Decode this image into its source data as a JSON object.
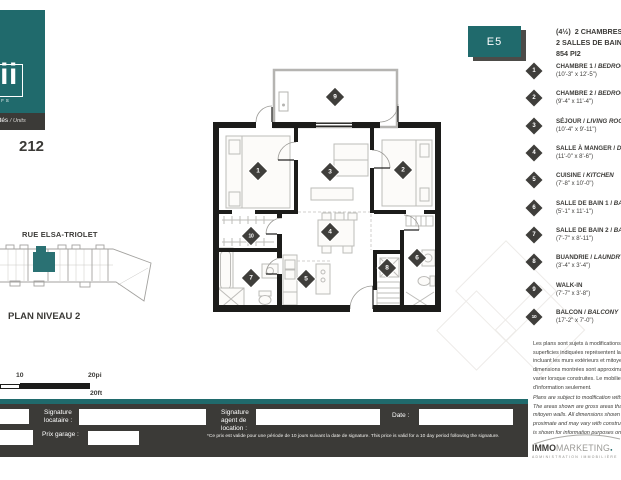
{
  "colors": {
    "teal": "#206a6c",
    "charcoal": "#3b3a37"
  },
  "brand": {
    "name": "mii",
    "tagline": "LOCATIFS",
    "units_label_fr": "Unités",
    "units_label_en": "/ Units",
    "unit_number": "212"
  },
  "unit": {
    "badge": "E5",
    "layout": "(4½)",
    "line1_fr": "2 CHAMBRES/",
    "line1_en": "BEDROOMS",
    "line2_fr": "2 SALLES DE BAIN/",
    "line2_en": "BATHROOMS",
    "area": "854 PI2"
  },
  "legend": {
    "items": [
      {
        "num": "1",
        "name_fr": "CHAMBRE 1 / ",
        "name_en": "BEDROOM 1",
        "dims": "(10'-3\" x 12'-5\")"
      },
      {
        "num": "2",
        "name_fr": "CHAMBRE 2 / ",
        "name_en": "BEDROOM 2",
        "dims": "(9'-4\" x 11'-4\")"
      },
      {
        "num": "3",
        "name_fr": "SÉJOUR / ",
        "name_en": "LIVING ROOM",
        "dims": "(10'-4\" x 9'-11\")"
      },
      {
        "num": "4",
        "name_fr": "SALLE À MANGER / ",
        "name_en": "DINING ROOM",
        "dims": "(11'-0\" x 8'-6\")"
      },
      {
        "num": "5",
        "name_fr": "CUISINE / ",
        "name_en": "KITCHEN",
        "dims": "(7'-8\" x 10'-0\")"
      },
      {
        "num": "6",
        "name_fr": "SALLE DE BAIN 1 / ",
        "name_en": "BATHROOM 1",
        "dims": "(5'-1\" x 11'-1\")"
      },
      {
        "num": "7",
        "name_fr": "SALLE DE BAIN 2 / ",
        "name_en": "BATHROOM 2",
        "dims": "(7'-7\" x 8'-11\")"
      },
      {
        "num": "8",
        "name_fr": "BUANDRIE / ",
        "name_en": "LAUNDRY",
        "dims": "(3'-4\" x 3'-4\")"
      },
      {
        "num": "9",
        "name_fr": "WALK-IN",
        "name_en": "",
        "dims": "(7'-7\" x 3'-8\")"
      },
      {
        "num": "10",
        "name_fr": "BALCON / ",
        "name_en": "BALCONY",
        "dims": "(17'-2\" x 7'-0\")"
      }
    ]
  },
  "plan": {
    "markers": [
      {
        "num": "1",
        "x": 258,
        "y": 171
      },
      {
        "num": "2",
        "x": 403,
        "y": 170
      },
      {
        "num": "3",
        "x": 330,
        "y": 172
      },
      {
        "num": "4",
        "x": 330,
        "y": 232
      },
      {
        "num": "5",
        "x": 306,
        "y": 279
      },
      {
        "num": "6",
        "x": 417,
        "y": 258
      },
      {
        "num": "7",
        "x": 251,
        "y": 278
      },
      {
        "num": "8",
        "x": 387,
        "y": 268
      },
      {
        "num": "9",
        "x": 335,
        "y": 97
      },
      {
        "num": "10",
        "x": 251,
        "y": 236
      }
    ]
  },
  "keyplan": {
    "street": "RUE ELSA-TRIOLET",
    "caption": "PLAN NIVEAU 2"
  },
  "scalebar": {
    "mid": "10",
    "right_top": "20pi",
    "right_bottom": "20ft"
  },
  "disclaimer_fr": {
    "lines": [
      "Les plans sont sujets à modifications sans préavis. Les",
      "superficies indiquées représentent la superficie brute,",
      "incluant les murs extérieurs et mitoyens. Toutes les",
      "dimensions montrées sont approximatives et peuvent",
      "varier lorsque construites. Le mobilier est montré à titre",
      "d'information seulement."
    ]
  },
  "disclaimer_en": {
    "lines": [
      "Plans are subject to modification without notice.",
      "The areas shown are gross areas that include the",
      "mitoyen walls. All dimensions shown are ap-",
      "proximate and may vary with construction. Furniture",
      "is shown for information purposes only."
    ]
  },
  "footer_logo": {
    "part1": "IMMO",
    "part2": "MARKETING",
    "sub": "ADMINISTRATION IMMOBILIÈRE"
  },
  "signature_bar": {
    "tenant_label_lines": [
      "Signature",
      "locataire :"
    ],
    "garage_label": "Prix garage :",
    "agent_label_lines": [
      "Signature",
      "agent de",
      "location :"
    ],
    "date_label": "Date :",
    "fine_print": "*Ce prix est valide pour une période de 10 jours suivant la date de signature. This price is valid for a 10 day period following the signature."
  }
}
